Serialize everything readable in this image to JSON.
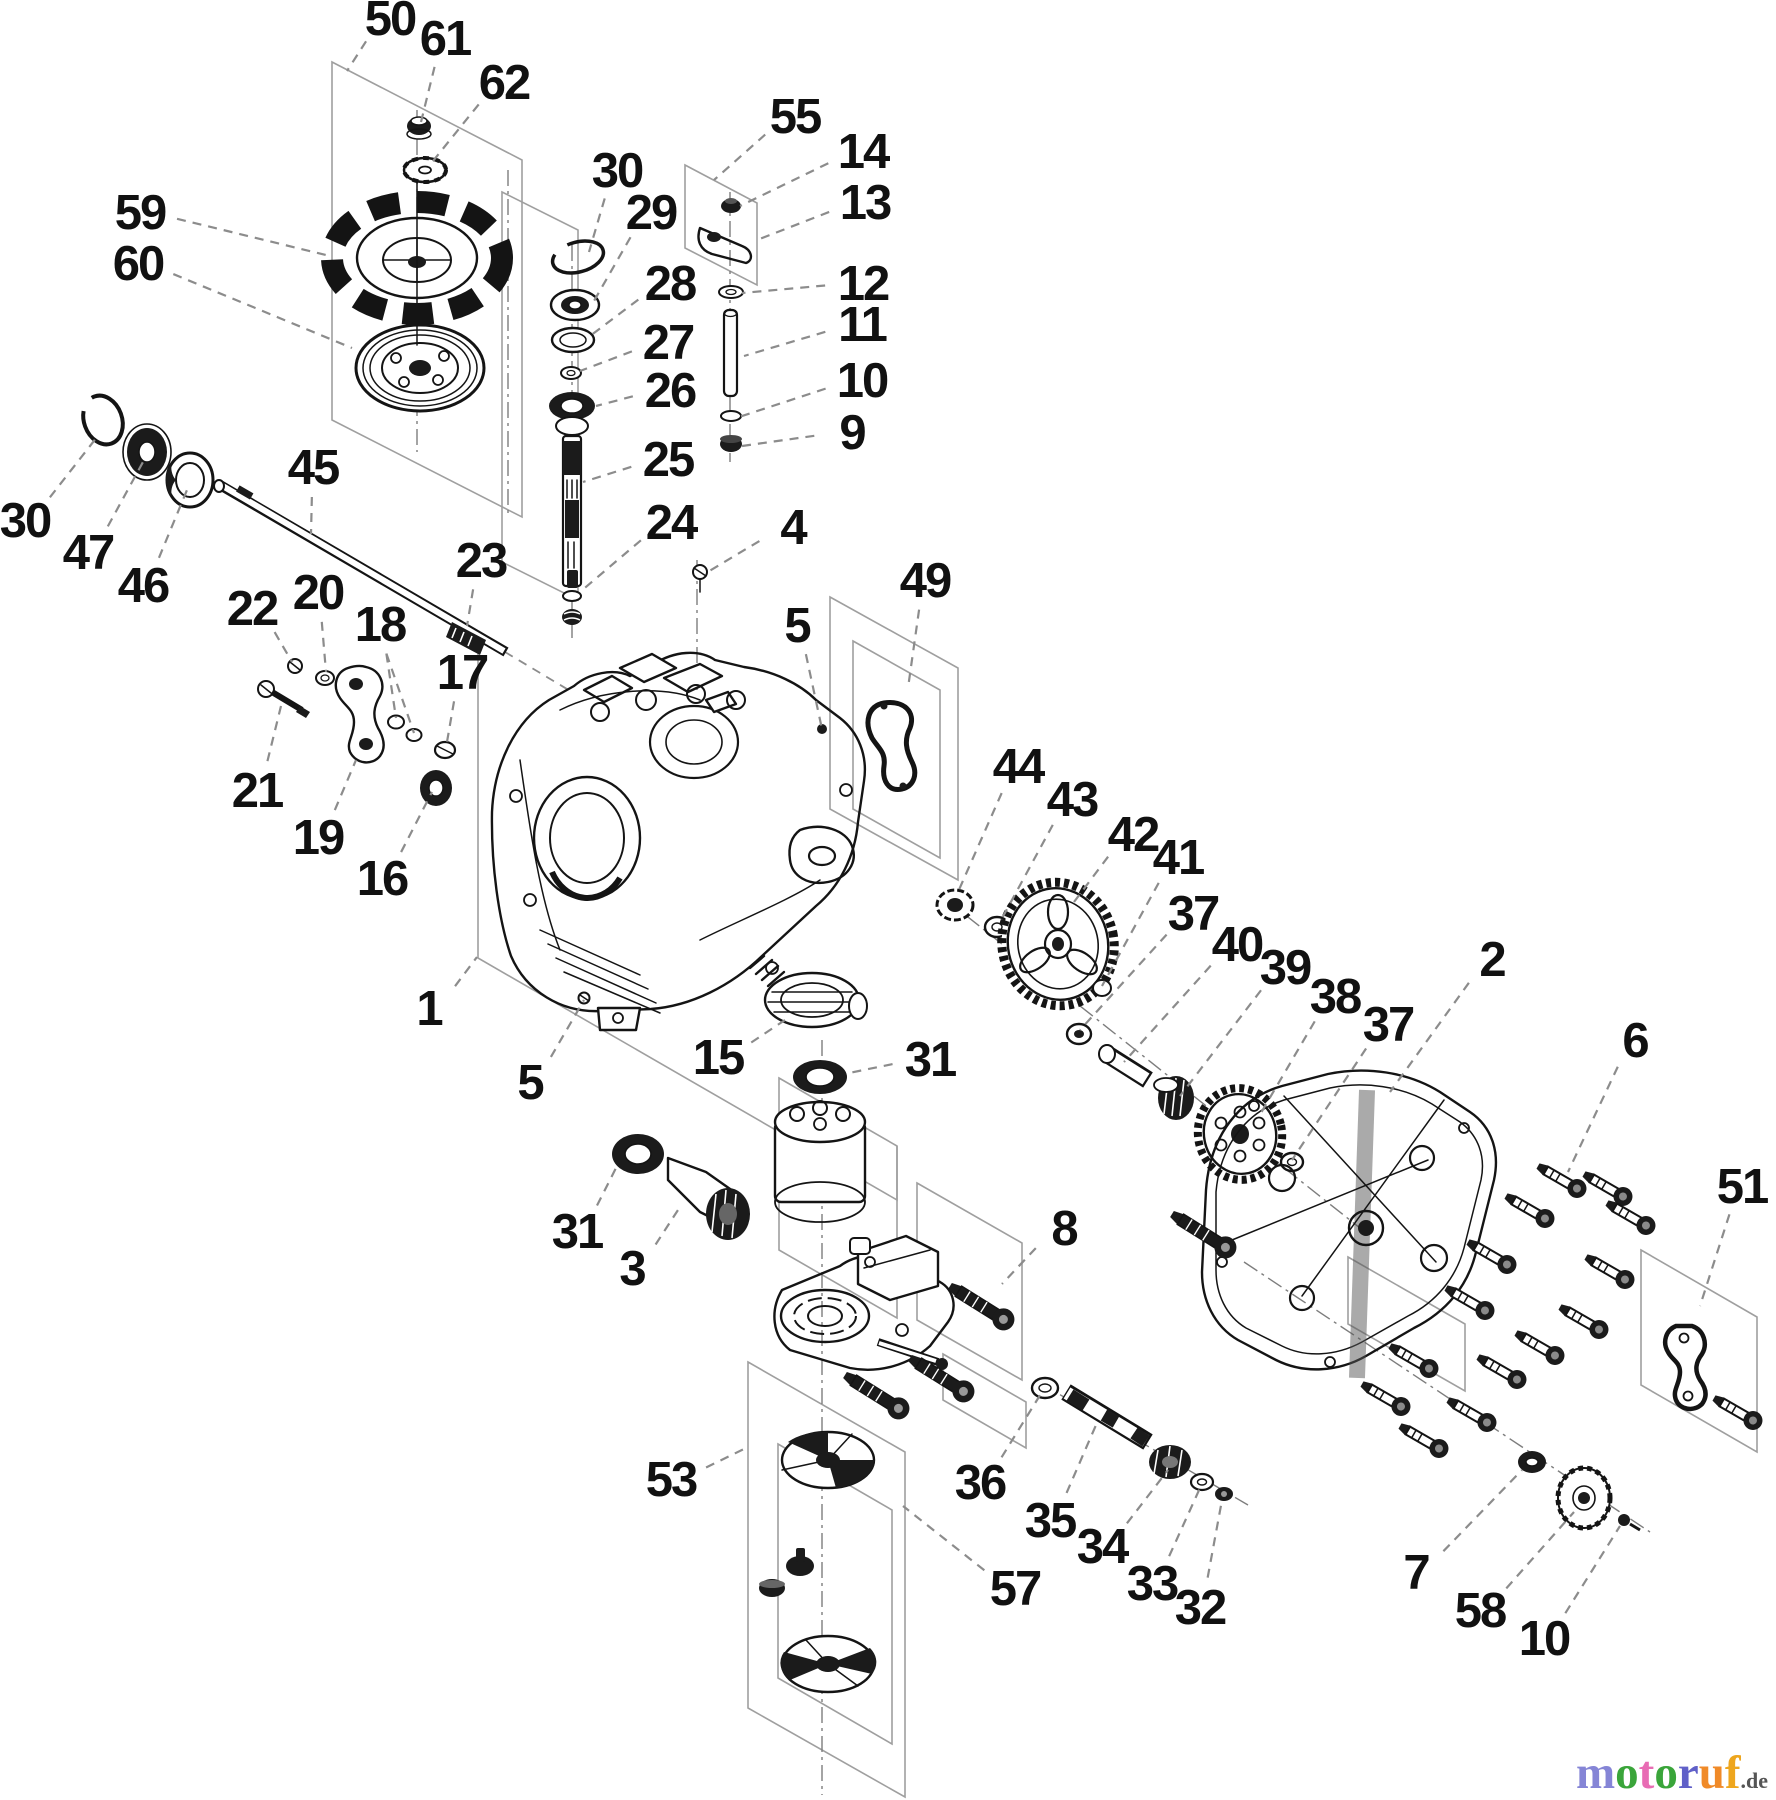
{
  "figure": {
    "kind": "exploded-parts-diagram",
    "style": "black-and-white line art with dashed leader lines and isometric grouping boxes",
    "background": "#ffffff",
    "line_color": "#141414",
    "leader_color": "#8c8c8c"
  },
  "watermark": {
    "letters": [
      {
        "ch": "m",
        "color": "#8585d6"
      },
      {
        "ch": "o",
        "color": "#3aa53a"
      },
      {
        "ch": "t",
        "color": "#e86cb4"
      },
      {
        "ch": "o",
        "color": "#3aa53a"
      },
      {
        "ch": "r",
        "color": "#6060c8"
      },
      {
        "ch": "u",
        "color": "#f08a28"
      },
      {
        "ch": "f",
        "color": "#eea61e"
      }
    ],
    "suffix": ".de",
    "suffix_color": "#555555"
  },
  "diagram": {
    "callouts": [
      {
        "n": "50",
        "x": 390,
        "y": 18,
        "tx": 347,
        "ty": 71
      },
      {
        "n": "61",
        "x": 445,
        "y": 38,
        "tx": 421,
        "ty": 122
      },
      {
        "n": "62",
        "x": 504,
        "y": 82,
        "tx": 429,
        "ty": 166
      },
      {
        "n": "59",
        "x": 140,
        "y": 212,
        "tx": 330,
        "ty": 256
      },
      {
        "n": "60",
        "x": 138,
        "y": 263,
        "tx": 352,
        "ty": 348
      },
      {
        "n": "30",
        "x": 617,
        "y": 170,
        "tx": 589,
        "ty": 252
      },
      {
        "n": "29",
        "x": 651,
        "y": 212,
        "tx": 594,
        "ty": 301
      },
      {
        "n": "28",
        "x": 670,
        "y": 283,
        "tx": 590,
        "ty": 336
      },
      {
        "n": "27",
        "x": 668,
        "y": 342,
        "tx": 580,
        "ty": 371
      },
      {
        "n": "26",
        "x": 670,
        "y": 390,
        "tx": 596,
        "ty": 406
      },
      {
        "n": "25",
        "x": 668,
        "y": 459,
        "tx": 583,
        "ty": 482
      },
      {
        "n": "24",
        "x": 671,
        "y": 522,
        "tx": 580,
        "ty": 592
      },
      {
        "n": "23",
        "x": 481,
        "y": 560,
        "tx": 467,
        "ty": 626
      },
      {
        "n": "55",
        "x": 795,
        "y": 116,
        "tx": 714,
        "ty": 180
      },
      {
        "n": "14",
        "x": 863,
        "y": 151,
        "tx": 740,
        "ty": 206
      },
      {
        "n": "13",
        "x": 865,
        "y": 202,
        "tx": 757,
        "ty": 240
      },
      {
        "n": "12",
        "x": 863,
        "y": 283,
        "tx": 742,
        "ty": 293
      },
      {
        "n": "11",
        "x": 862,
        "y": 324,
        "tx": 744,
        "ty": 356
      },
      {
        "n": "10",
        "x": 862,
        "y": 380,
        "tx": 739,
        "ty": 417
      },
      {
        "n": "9",
        "x": 852,
        "y": 432,
        "tx": 742,
        "ty": 446
      },
      {
        "n": "4",
        "x": 793,
        "y": 527,
        "tx": 706,
        "ty": 573
      },
      {
        "n": "49",
        "x": 925,
        "y": 580,
        "tx": 908,
        "ty": 688
      },
      {
        "n": "5",
        "x": 797,
        "y": 625,
        "tx": 822,
        "ty": 729
      },
      {
        "n": "30",
        "x": 25,
        "y": 520,
        "tx": 97,
        "ty": 437
      },
      {
        "n": "47",
        "x": 88,
        "y": 552,
        "tx": 143,
        "ty": 462
      },
      {
        "n": "46",
        "x": 143,
        "y": 585,
        "tx": 187,
        "ty": 490
      },
      {
        "n": "45",
        "x": 313,
        "y": 467,
        "tx": 311,
        "ty": 534
      },
      {
        "n": "22",
        "x": 252,
        "y": 608,
        "tx": 292,
        "ty": 662
      },
      {
        "n": "20",
        "x": 318,
        "y": 592,
        "tx": 326,
        "ty": 672
      },
      {
        "n": "18",
        "x": 380,
        "y": 624,
        "tx": 396,
        "ty": 718,
        "tx2": 414,
        "ty2": 733
      },
      {
        "n": "17",
        "x": 462,
        "y": 672,
        "tx": 447,
        "ty": 742
      },
      {
        "n": "21",
        "x": 257,
        "y": 790,
        "tx": 281,
        "ty": 706
      },
      {
        "n": "19",
        "x": 318,
        "y": 837,
        "tx": 356,
        "ty": 760
      },
      {
        "n": "16",
        "x": 382,
        "y": 878,
        "tx": 432,
        "ty": 792
      },
      {
        "n": "1",
        "x": 429,
        "y": 1008,
        "tx": 477,
        "ty": 957
      },
      {
        "n": "5",
        "x": 530,
        "y": 1082,
        "tx": 584,
        "ty": 1000
      },
      {
        "n": "15",
        "x": 718,
        "y": 1057,
        "tx": 785,
        "ty": 1020
      },
      {
        "n": "31",
        "x": 930,
        "y": 1059,
        "tx": 849,
        "ty": 1073
      },
      {
        "n": "31",
        "x": 577,
        "y": 1231,
        "tx": 616,
        "ty": 1168
      },
      {
        "n": "3",
        "x": 632,
        "y": 1268,
        "tx": 678,
        "ty": 1210
      },
      {
        "n": "44",
        "x": 1018,
        "y": 766,
        "tx": 958,
        "ty": 892
      },
      {
        "n": "43",
        "x": 1072,
        "y": 799,
        "tx": 1000,
        "ty": 922
      },
      {
        "n": "42",
        "x": 1133,
        "y": 834,
        "tx": 1074,
        "ty": 902
      },
      {
        "n": "41",
        "x": 1178,
        "y": 857,
        "tx": 1102,
        "ty": 986
      },
      {
        "n": "37",
        "x": 1193,
        "y": 913,
        "tx": 1080,
        "ty": 1030
      },
      {
        "n": "40",
        "x": 1237,
        "y": 944,
        "tx": 1124,
        "ty": 1062
      },
      {
        "n": "39",
        "x": 1285,
        "y": 967,
        "tx": 1180,
        "ty": 1096
      },
      {
        "n": "38",
        "x": 1335,
        "y": 996,
        "tx": 1258,
        "ty": 1118
      },
      {
        "n": "37",
        "x": 1388,
        "y": 1024,
        "tx": 1292,
        "ty": 1160
      },
      {
        "n": "2",
        "x": 1492,
        "y": 959,
        "tx": 1390,
        "ty": 1092
      },
      {
        "n": "6",
        "x": 1635,
        "y": 1040,
        "tx": 1568,
        "ty": 1172
      },
      {
        "n": "51",
        "x": 1742,
        "y": 1186,
        "tx": 1700,
        "ty": 1306
      },
      {
        "n": "8",
        "x": 1064,
        "y": 1228,
        "tx": 1002,
        "ty": 1284
      },
      {
        "n": "53",
        "x": 671,
        "y": 1479,
        "tx": 748,
        "ty": 1447
      },
      {
        "n": "36",
        "x": 980,
        "y": 1482,
        "tx": 1042,
        "ty": 1392
      },
      {
        "n": "35",
        "x": 1050,
        "y": 1520,
        "tx": 1096,
        "ty": 1425
      },
      {
        "n": "34",
        "x": 1102,
        "y": 1546,
        "tx": 1168,
        "ty": 1470
      },
      {
        "n": "33",
        "x": 1152,
        "y": 1583,
        "tx": 1200,
        "ty": 1488
      },
      {
        "n": "32",
        "x": 1200,
        "y": 1607,
        "tx": 1222,
        "ty": 1500
      },
      {
        "n": "57",
        "x": 1015,
        "y": 1588,
        "tx": 903,
        "ty": 1506
      },
      {
        "n": "7",
        "x": 1416,
        "y": 1572,
        "tx": 1522,
        "ty": 1470
      },
      {
        "n": "58",
        "x": 1480,
        "y": 1610,
        "tx": 1574,
        "ty": 1512
      },
      {
        "n": "10",
        "x": 1544,
        "y": 1638,
        "tx": 1620,
        "ty": 1526
      }
    ]
  }
}
